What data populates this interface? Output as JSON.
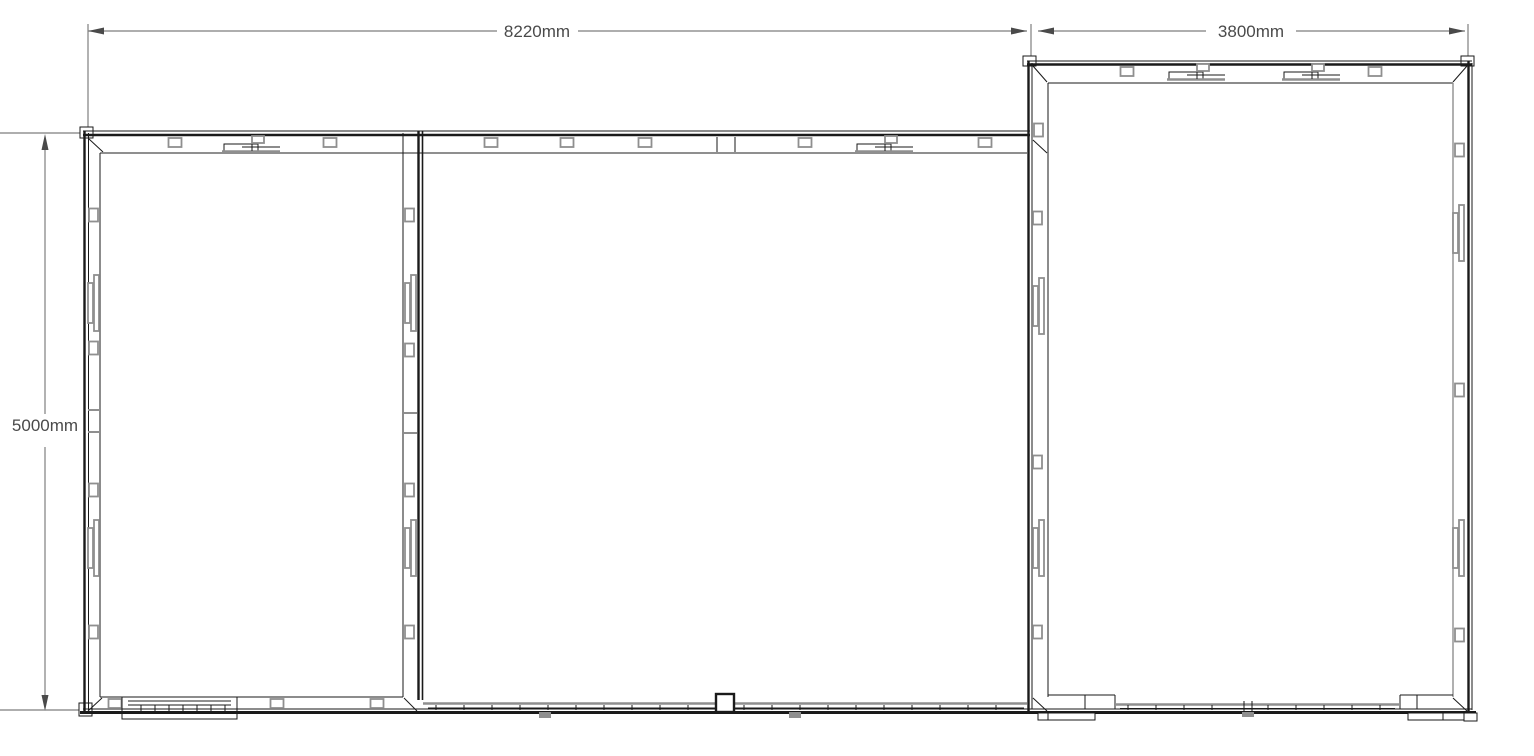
{
  "drawing": {
    "type": "floor-plan",
    "dimensions": {
      "main_width": "8220mm",
      "annex_width": "3800mm",
      "main_depth": "5000mm"
    },
    "colors": {
      "background": "#ffffff",
      "wall_line": "#1a1a1a",
      "detail_line": "#8f8f8f",
      "dimension_line": "#7e7e7e",
      "dimension_text": "#4a4a4a"
    }
  }
}
